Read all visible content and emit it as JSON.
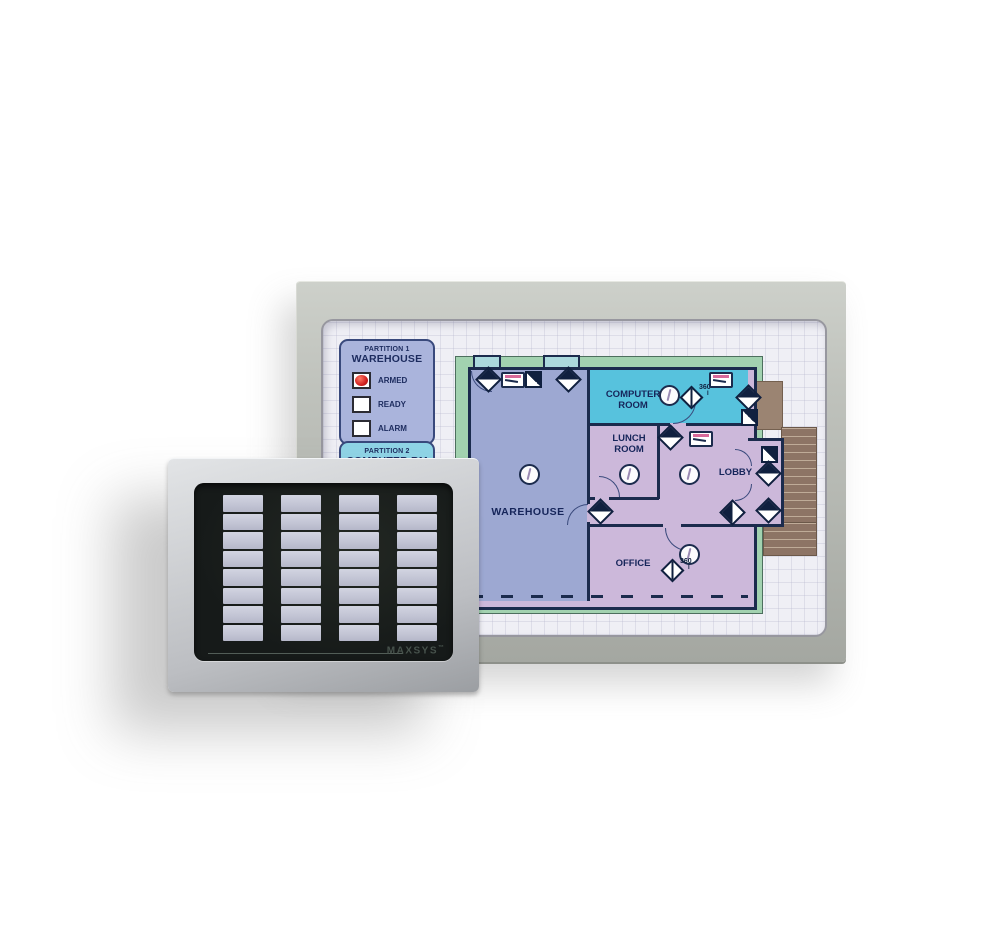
{
  "main_panel": {
    "partition_1": {
      "line1": "PARTITION 1",
      "line2": "WAREHOUSE",
      "indicators": [
        {
          "label": "ARMED",
          "lit": true,
          "led_color": "#d02020"
        },
        {
          "label": "READY",
          "lit": false,
          "led_color": "#ffffff"
        },
        {
          "label": "ALARM",
          "lit": false,
          "led_color": "#ffffff"
        }
      ]
    },
    "partition_2": {
      "line1": "PARTITION 2",
      "line2": "COMPUTER RM"
    },
    "floorplan": {
      "rooms": [
        {
          "name": "WAREHOUSE",
          "fill": "#9da8d2"
        },
        {
          "name": "COMPUTER ROOM",
          "fill": "#57c2dd"
        },
        {
          "name": "LUNCH ROOM",
          "fill": "#ccb8da"
        },
        {
          "name": "LOBBY",
          "fill": "#ccb8da"
        },
        {
          "name": "OFFICE",
          "fill": "#ccb8da"
        }
      ],
      "angle_label": "360",
      "angle_flag": "I",
      "icons": {
        "door-contact-icon": "two-tone diamond",
        "motion-detector-icon": "circle with squiggle",
        "keypad-station-icon": "small rectangle with pink bar",
        "corner-sensor-icon": "diagonally split square"
      },
      "wall_color": "#1b2b4d",
      "border_color": "#a2d2b0"
    }
  },
  "annunciator": {
    "brand_label": "MAXSYS",
    "trademark": "™",
    "columns": 4,
    "rows": 8,
    "cell_color": "#c3c5d5",
    "face_color": "#161a19"
  }
}
